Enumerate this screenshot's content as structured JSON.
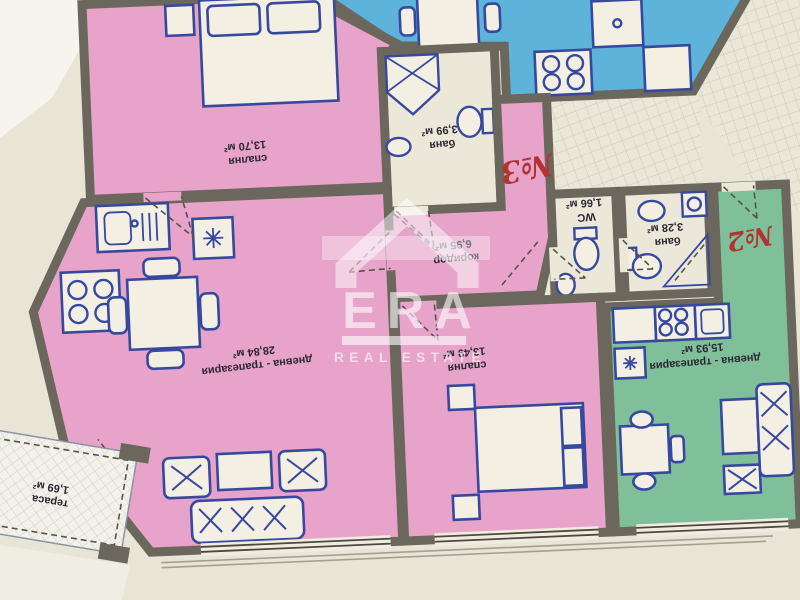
{
  "plan": {
    "apartment_3": {
      "number_label": "№3",
      "rooms": {
        "bedroom_top": {
          "name": "спалня",
          "area": "13,70 м²"
        },
        "bathroom": {
          "name": "баня",
          "area": "3,99 м²"
        },
        "corridor": {
          "name": "коридор",
          "area": "6,95 м²"
        },
        "living_dining": {
          "name": "дневна - трапезария",
          "area": "28,84 м²"
        },
        "bedroom_bottom": {
          "name": "спалня",
          "area": "13,49 м²"
        },
        "terrace": {
          "name": "тераса",
          "area": "1,69 м²"
        }
      }
    },
    "apartment_2": {
      "number_label": "№2",
      "rooms": {
        "wc": {
          "name": "WC",
          "area": "1,66 м²"
        },
        "bathroom": {
          "name": "баня",
          "area": "3,28 м²"
        },
        "living_dining": {
          "name": "дневна - трапезария",
          "area": "15,93 м²"
        }
      }
    },
    "colors": {
      "apartment3_pink": "#e7a3c9",
      "apartment2_green": "#7fc09b",
      "neighbour_blue": "#5eb3da",
      "wet_room_beige": "#ece8d9",
      "walls": "#6c675c",
      "furniture_blue": "#37499e",
      "apartment_number_red": "#b23430",
      "paper": "#e8e4d6"
    }
  },
  "watermark": {
    "brand": "ERA",
    "tagline": "REAL ESTATE"
  }
}
